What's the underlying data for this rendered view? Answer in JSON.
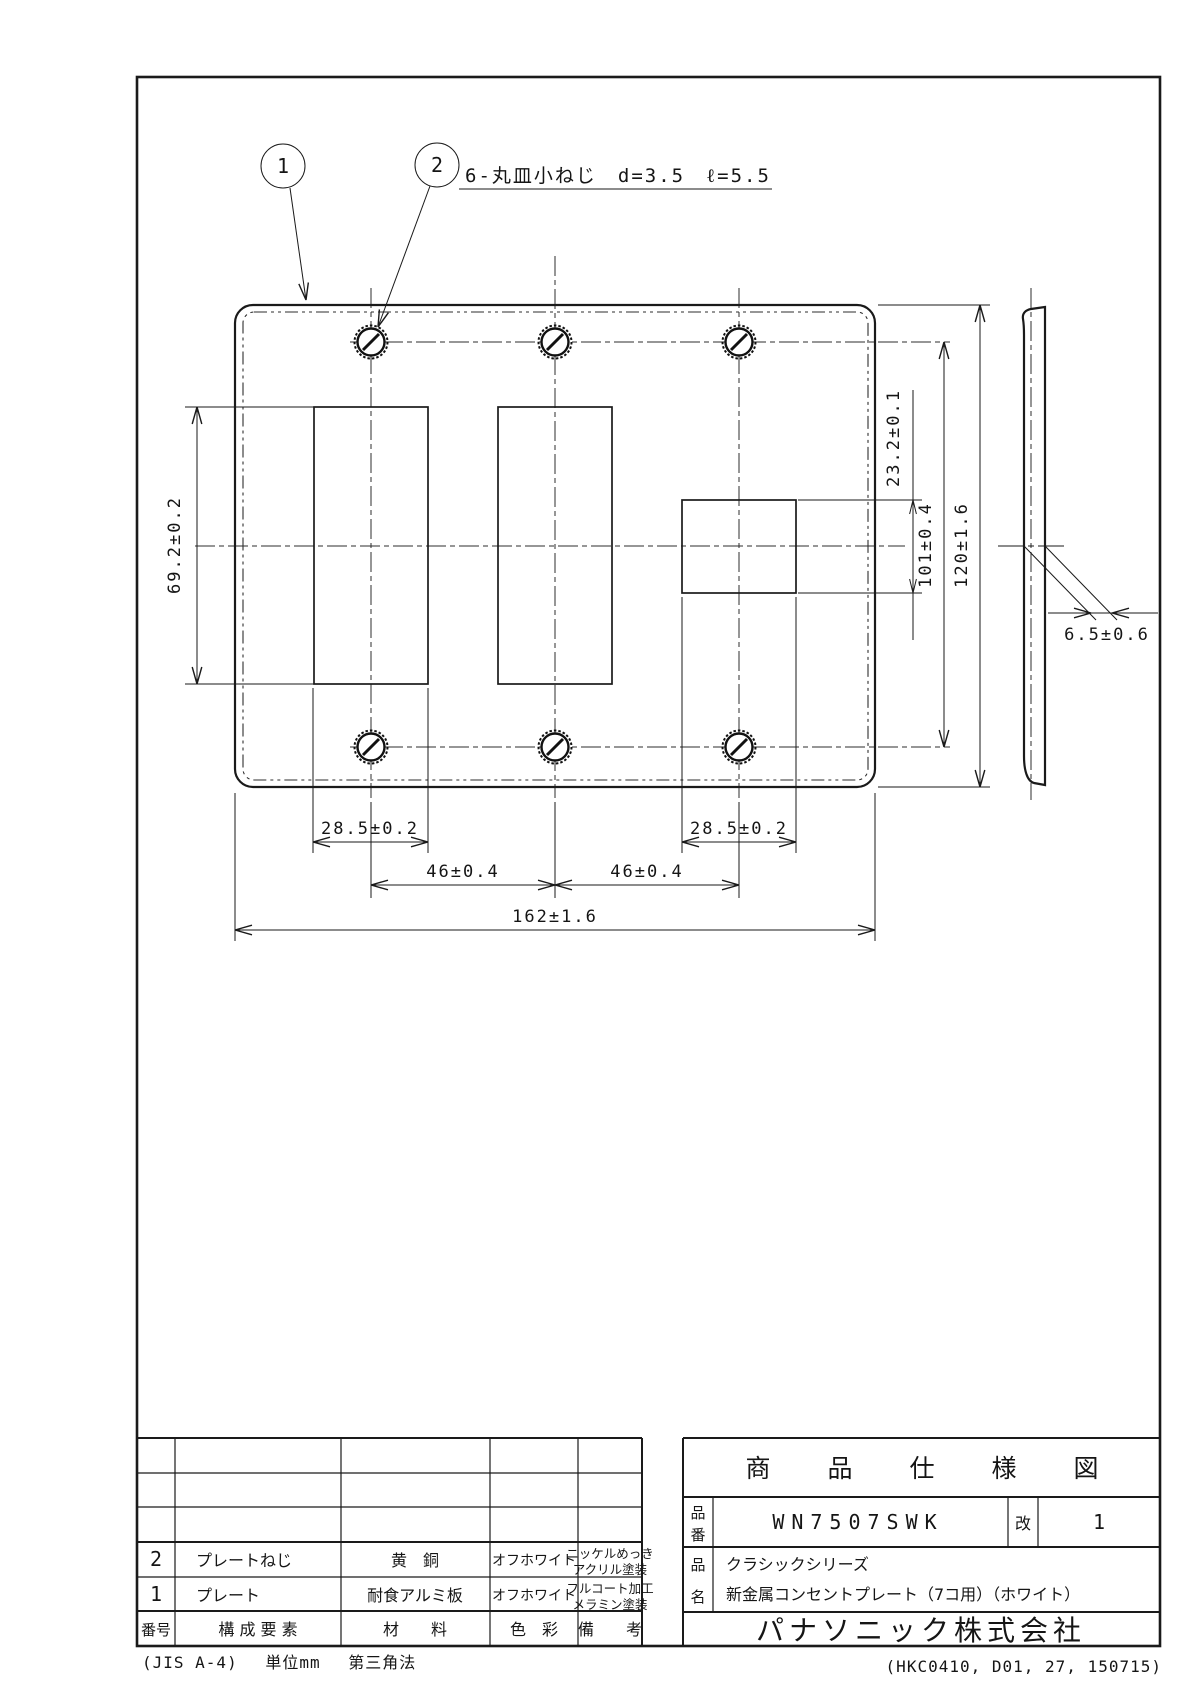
{
  "drawing": {
    "callouts": {
      "c1": "1",
      "c2": "2"
    },
    "screw_note": "6-丸皿小ねじ　d=3.5　ℓ=5.5",
    "dimensions": {
      "opening_height": "69.2±0.2",
      "square_height": "23.2±0.1",
      "screw_row_pitch": "101±0.4",
      "plate_height": "120±1.6",
      "thickness": "6.5±0.6",
      "opening_width_left": "28.5±0.2",
      "opening_width_right": "28.5±0.2",
      "screw_col_pitch_left": "46±0.4",
      "screw_col_pitch_right": "46±0.4",
      "plate_width": "162±1.6"
    }
  },
  "title_block": {
    "doc_title": "商　品　仕　様　図",
    "part_no_label": [
      "品",
      "番"
    ],
    "part_number": "WN7507SWK",
    "rev_label": "改",
    "rev_value": "1",
    "product_name_label": [
      "品",
      "名"
    ],
    "product_series": "クラシックシリーズ",
    "product_name": "新金属コンセントプレート（7コ用）（ホワイト）",
    "company": "パナソニック株式会社",
    "parts_table": {
      "headers": {
        "no": "番号",
        "component": "構  成  要  素",
        "material": "材　　料",
        "color": "色　彩",
        "remarks": "備　　考"
      },
      "rows": [
        {
          "no": "2",
          "component": "プレートねじ",
          "material": "黄　銅",
          "color": "オフホワイト",
          "remarks1": "ニッケルめっき",
          "remarks2": "アクリル塗装"
        },
        {
          "no": "1",
          "component": "プレート",
          "material": "耐食アルミ板",
          "color": "オフホワイト",
          "remarks1": "フルコート加工",
          "remarks2": "メラミン塗装"
        }
      ]
    }
  },
  "footer": {
    "left": "(JIS A-4)　 単位mm　 第三角法",
    "right": "(HKC0410, D01, 27, 150715)"
  }
}
